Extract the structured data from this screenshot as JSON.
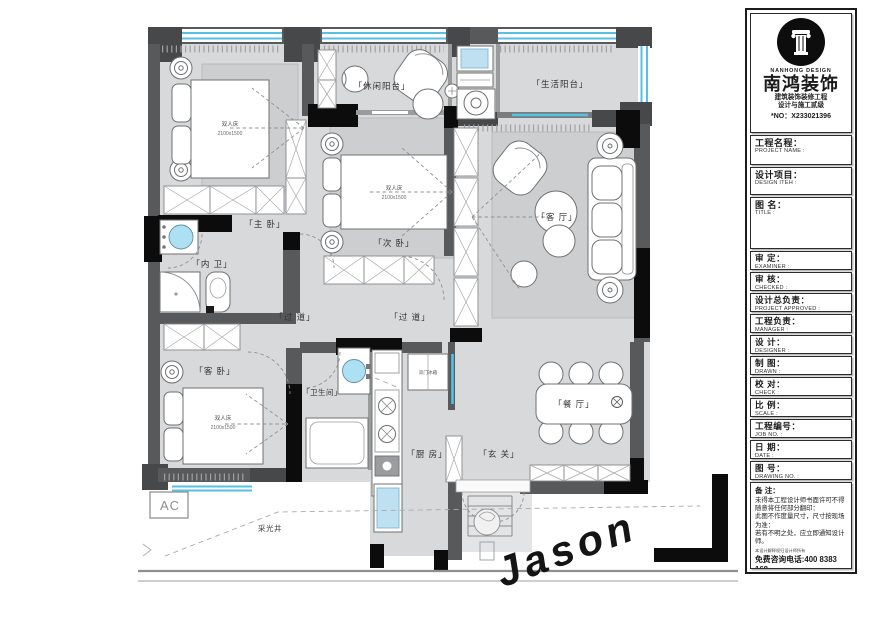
{
  "titleblock": {
    "brand": {
      "logo_text": "NANHONG DESIGN",
      "name": "南鸿装饰",
      "cert_line1": "建筑装饰装修工程",
      "cert_line2": "设计与施工贰级",
      "cert_no": "*NO：X233021396"
    },
    "fields": [
      {
        "cn": "工程名程：",
        "en": "PROJECT NAME :"
      },
      {
        "cn": "设计项目：",
        "en": "DESIGN ITEH :"
      },
      {
        "cn": "图  名：",
        "en": "TITLE :"
      },
      {
        "cn": "审  定：",
        "en": "EXAMINER :"
      },
      {
        "cn": "审  核：",
        "en": "CHECKED :"
      },
      {
        "cn": "设计总负责：",
        "en": "PROJECT APPROVED :"
      },
      {
        "cn": "工程负责：",
        "en": "MANAGER :"
      },
      {
        "cn": "设  计：",
        "en": "DESIGNER :"
      },
      {
        "cn": "制  图：",
        "en": "DRAWN :"
      },
      {
        "cn": "校  对：",
        "en": "CHECK :"
      },
      {
        "cn": "比  例：",
        "en": "SCALE :"
      },
      {
        "cn": "工程编号：",
        "en": "JOB NO. :"
      },
      {
        "cn": "日  期：",
        "en": "DATE :"
      },
      {
        "cn": "图  号：",
        "en": "DRAWING NO. :"
      }
    ],
    "notes": {
      "title": "备 注：",
      "lines": [
        "未得本工程设计师书面许可不得",
        "随意将任何部分翻印：",
        "此图不作度量尺寸，尺寸按现场",
        "为准：",
        "若有不明之处，应立即通知设计",
        "师。"
      ],
      "fine_print": "本设计解释权归设计师所有",
      "hotline": "免费咨询电话:400 8383 168"
    }
  },
  "floorplan": {
    "rooms": {
      "master_bedroom": "「主 卧」",
      "inner_bathroom": "「内 卫」",
      "guest_bedroom": "「客 卧」",
      "leisure_balcony": "「休闲阳台」",
      "second_bedroom": "「次 卧」",
      "living_balcony": "「生活阳台」",
      "living_room": "「客 厅」",
      "corridor_1": "「过 道」",
      "corridor_2": "「过 道」",
      "bathroom": "「卫生间」",
      "kitchen": "「厨 房」",
      "entry": "「玄 关」",
      "dining_room": "「餐 厅」",
      "light_well": "采光井"
    },
    "furniture": {
      "double_bed": "双人床",
      "bed_size": "2100x1500",
      "fridge": "双门冰箱",
      "ac": "AC"
    },
    "signature": "Jason"
  },
  "colors": {
    "wall_grey": "#58595b",
    "wall_black": "#0c0c0d",
    "floor": "#d8d9da",
    "window_cyan": "#55c1e4",
    "water_blue": "#aee0f4",
    "rug": "#cdced0"
  }
}
